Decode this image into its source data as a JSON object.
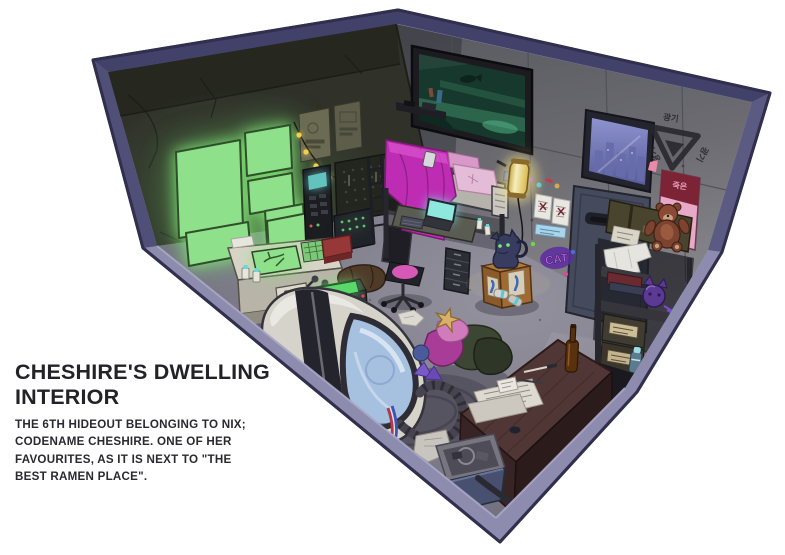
{
  "artwork": {
    "title_lines": [
      "CHESHIRE'S DWELLING",
      "INTERIOR"
    ],
    "description_lines": [
      "THE 6TH HIDEOUT BELONGING TO NIX;",
      "CODENAME CHESHIRE. ONE OF HER",
      "FAVOURITES, AS IT IS NEXT TO \"THE",
      "BEST RAMEN PLACE\"."
    ]
  },
  "room_labels": {
    "hazard_stencil": "광기",
    "poster_vertical_text": "죽은",
    "wall_graffiti": "CAT"
  },
  "colors": {
    "background": "#FFFFFF",
    "room_edge_light": "#8E8CAE",
    "room_edge_dark": "#45446D",
    "left_wall": "#30322A",
    "right_wall": "#67676D",
    "floor": "#7E7C8A",
    "screen_green": "#8FE08B",
    "blanket_magenta": "#BF2CB4",
    "lamp_yellow": "#F2DF7E",
    "glass_blue": "#A6C0E0",
    "text_dark": "#232227"
  }
}
